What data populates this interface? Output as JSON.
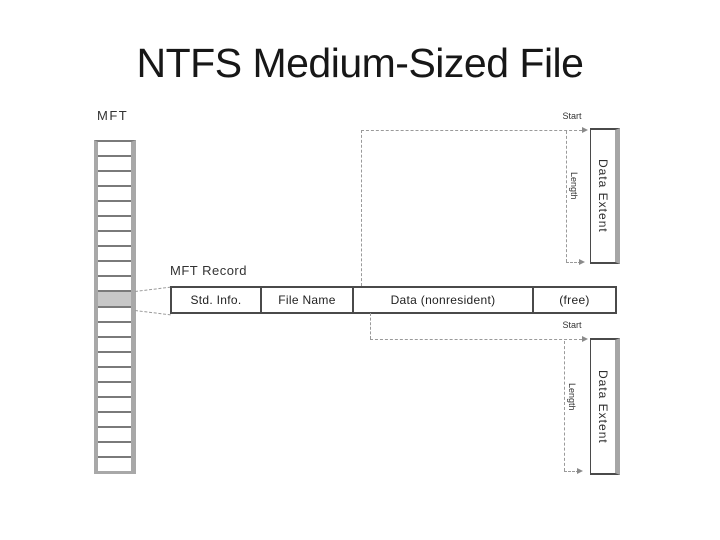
{
  "slide": {
    "title": "NTFS Medium-Sized File"
  },
  "diagram": {
    "mft": {
      "label": "MFT",
      "cell_count": 22,
      "highlighted_cell_index": 10
    },
    "mft_record": {
      "label": "MFT Record",
      "cells": [
        {
          "label": "Std. Info.",
          "width_px": 88
        },
        {
          "label": "File Name",
          "width_px": 92
        },
        {
          "label": "Data (nonresident)",
          "width_px": 180
        },
        {
          "label": "(free)",
          "width_px": 87
        }
      ]
    },
    "extents": [
      {
        "label": "Data Extent",
        "start_label": "Start",
        "length_label": "Length"
      },
      {
        "label": "Data Extent",
        "start_label": "Start",
        "length_label": "Length"
      }
    ],
    "colors": {
      "background": "#ffffff",
      "title_text": "#171717",
      "box_border_dark": "#4a4a4a",
      "box_shadow_gray": "#a8a8a8",
      "dashed_connector": "#9a9a9a",
      "highlighted_cell_fill": "#c7c7c7",
      "label_text": "#333333"
    }
  }
}
